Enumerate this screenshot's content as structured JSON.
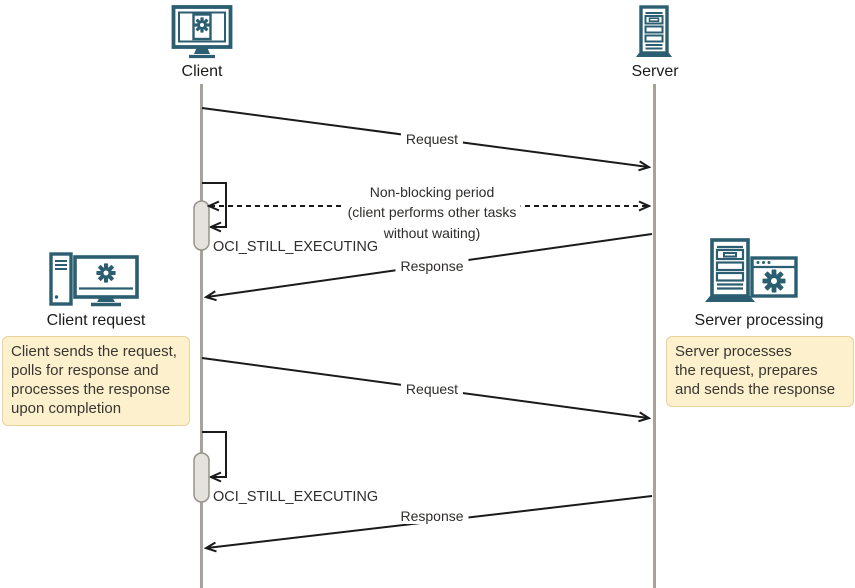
{
  "actors": {
    "client": {
      "label": "Client",
      "icon": "monitor-gear-icon"
    },
    "server": {
      "label": "Server",
      "icon": "server-rack-icon"
    }
  },
  "messages": {
    "request_1": "Request",
    "non_blocking": {
      "line1": "Non-blocking period",
      "line2": "(client performs other tasks",
      "line3": "without waiting)"
    },
    "still_executing_1": "OCI_STILL_EXECUTING",
    "response_1": "Response",
    "request_2": "Request",
    "still_executing_2": "OCI_STILL_EXECUTING",
    "response_2": "Response"
  },
  "side_notes": {
    "client": {
      "title": "Client request",
      "icon": "desktop-tower-monitor-gear-icon",
      "line1": "Client sends the request,",
      "line2": "polls for response and",
      "line3": "processes the response",
      "line4": "upon completion"
    },
    "server": {
      "title": "Server processing",
      "icon": "server-rack-app-gear-icon",
      "line1": "Server processes",
      "line2": "the request, prepares",
      "line3": "and sends the response"
    }
  },
  "colors": {
    "icon_teal": "#2a5e70",
    "lifeline": "#a7a29a",
    "activation_fill": "#e4e2dd",
    "activation_border": "#97938b",
    "arrow": "#1a1a1a",
    "note_fill": "#fdf0cd",
    "note_border": "#e9d29c"
  }
}
